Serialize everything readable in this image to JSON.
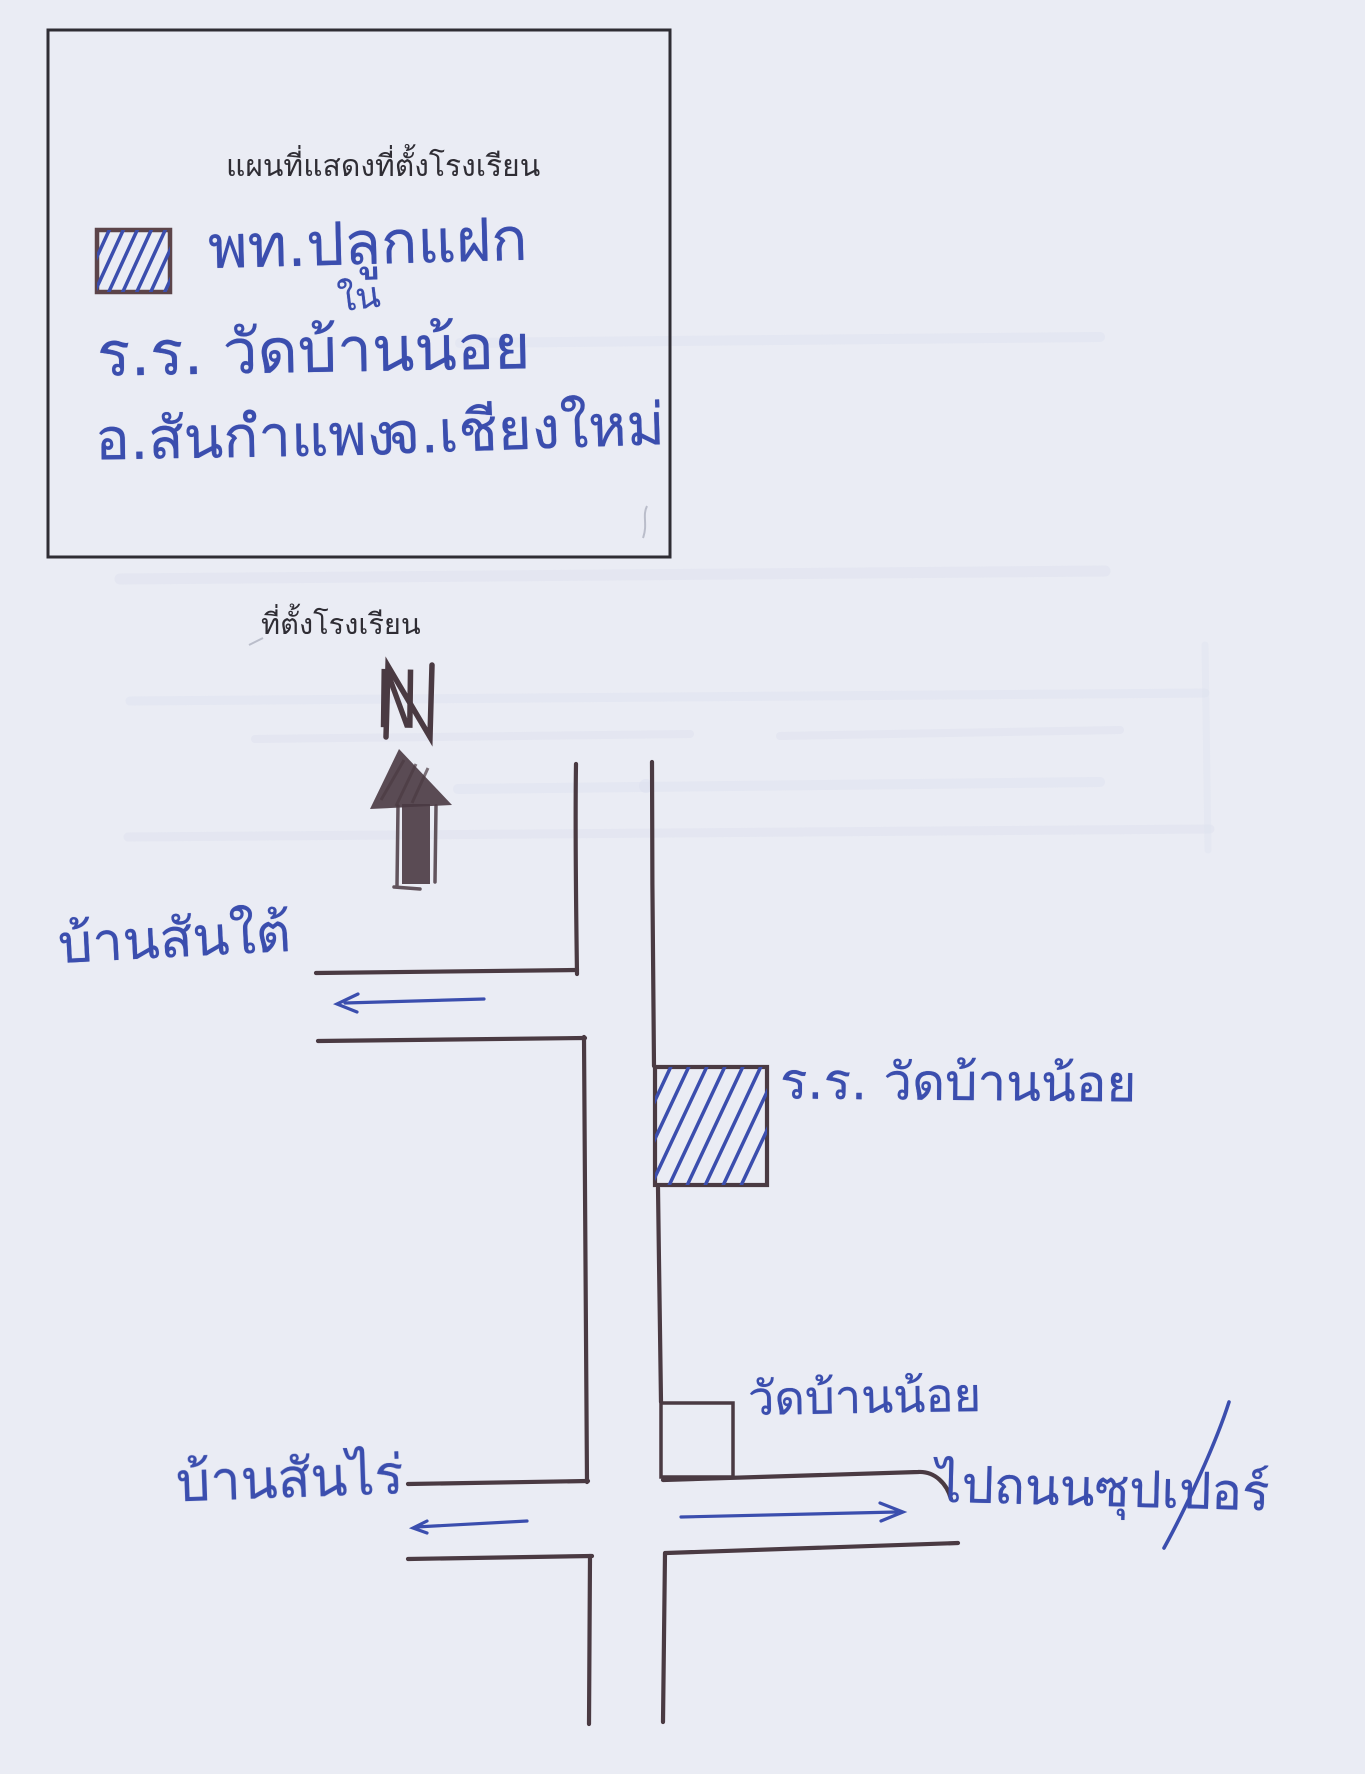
{
  "legend_box": {
    "title": "แผนที่แสดงที่ตั้งโรงเรียน",
    "symbol_label": "พท.ปลูกแฝก",
    "inserted_word": "ใน",
    "school_line": "ร.ร. วัดบ้านน้อย",
    "district": "อ.สันกำแพง",
    "province": "จ.เชียงใหม่"
  },
  "map": {
    "caption": "ที่ตั้งโรงเรียน",
    "north_label": "N",
    "west_road_label": "บ้านสันใต้",
    "school_label": "ร.ร. วัดบ้านน้อย",
    "temple_label": "วัดบ้านน้อย",
    "southwest_road_label": "บ้านสันไร่",
    "southeast_road_label": "ไปถนนซุปเปอร์"
  },
  "colors": {
    "paper": "#eaecf4",
    "ink": "#2f2d34",
    "road": "#4a3a42",
    "pen": "#3b4eae",
    "swatch_border": "#5c4449",
    "pencil": "#a9adbc",
    "ghost": "#dce0ee"
  }
}
